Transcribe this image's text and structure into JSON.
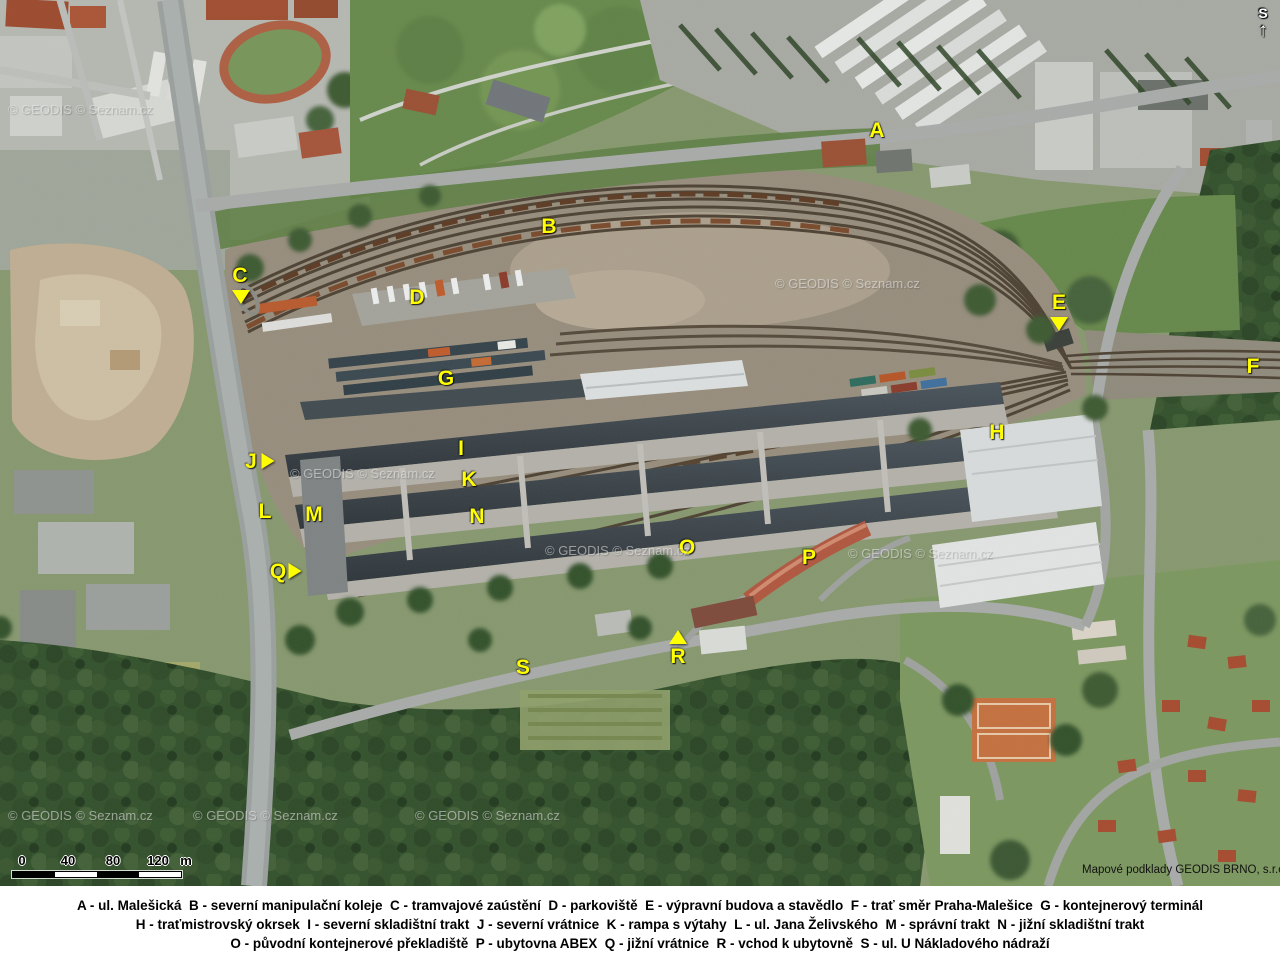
{
  "map": {
    "credit": "Mapové podklady GEODIS BRNO, s.r.o.",
    "watermark_text": "© GEODIS © Seznam.cz",
    "north_letter": "S",
    "north_arrow": "↑",
    "label_color": "#ffff00",
    "labels": [
      {
        "letter": "A",
        "x": 877,
        "y": 131
      },
      {
        "letter": "B",
        "x": 549,
        "y": 227
      },
      {
        "letter": "C",
        "x": 240,
        "y": 276
      },
      {
        "letter": "D",
        "x": 417,
        "y": 298
      },
      {
        "letter": "E",
        "x": 1059,
        "y": 303
      },
      {
        "letter": "F",
        "x": 1253,
        "y": 367
      },
      {
        "letter": "G",
        "x": 446,
        "y": 379
      },
      {
        "letter": "H",
        "x": 997,
        "y": 433
      },
      {
        "letter": "I",
        "x": 461,
        "y": 449
      },
      {
        "letter": "J",
        "x": 251,
        "y": 462
      },
      {
        "letter": "K",
        "x": 469,
        "y": 480
      },
      {
        "letter": "L",
        "x": 265,
        "y": 512
      },
      {
        "letter": "M",
        "x": 314,
        "y": 515
      },
      {
        "letter": "N",
        "x": 477,
        "y": 517
      },
      {
        "letter": "O",
        "x": 687,
        "y": 548
      },
      {
        "letter": "P",
        "x": 809,
        "y": 558
      },
      {
        "letter": "Q",
        "x": 278,
        "y": 572
      },
      {
        "letter": "R",
        "x": 678,
        "y": 657
      },
      {
        "letter": "S",
        "x": 523,
        "y": 668
      }
    ],
    "markers": [
      {
        "for": "C",
        "dir": "down",
        "x": 241,
        "y": 297
      },
      {
        "for": "E",
        "dir": "down",
        "x": 1059,
        "y": 324
      },
      {
        "for": "J",
        "dir": "right",
        "x": 268,
        "y": 461
      },
      {
        "for": "Q",
        "dir": "right",
        "x": 295,
        "y": 571
      },
      {
        "for": "R",
        "dir": "up",
        "x": 678,
        "y": 637
      }
    ],
    "watermarks": [
      {
        "x": 8,
        "y": 102
      },
      {
        "x": 775,
        "y": 276
      },
      {
        "x": 290,
        "y": 466
      },
      {
        "x": 545,
        "y": 543
      },
      {
        "x": 848,
        "y": 546
      },
      {
        "x": 8,
        "y": 808
      },
      {
        "x": 193,
        "y": 808
      },
      {
        "x": 415,
        "y": 808
      }
    ],
    "scale_bar": {
      "ticks": [
        "0",
        "40",
        "80",
        "120"
      ],
      "unit": "m"
    }
  },
  "legend": {
    "lines": [
      "A - ul. Malešická  B - severní manipulační koleje  C - tramvajové zaústění  D - parkoviště  E - výpravní budova a stavědlo  F - trať směr Praha-Malešice  G - kontejnerový terminál",
      "H - traťmistrovský okrsek  I - severní skladištní trakt  J - severní vrátnice  K - rampa s výtahy  L - ul. Jana Želivského  M - správní trakt  N - jižní skladištní trakt",
      "O - původní kontejnerové překladiště  P - ubytovna ABEX  Q - jižní vrátnice  R - vchod k ubytovně  S - ul. U Nákladového nádraží"
    ]
  }
}
